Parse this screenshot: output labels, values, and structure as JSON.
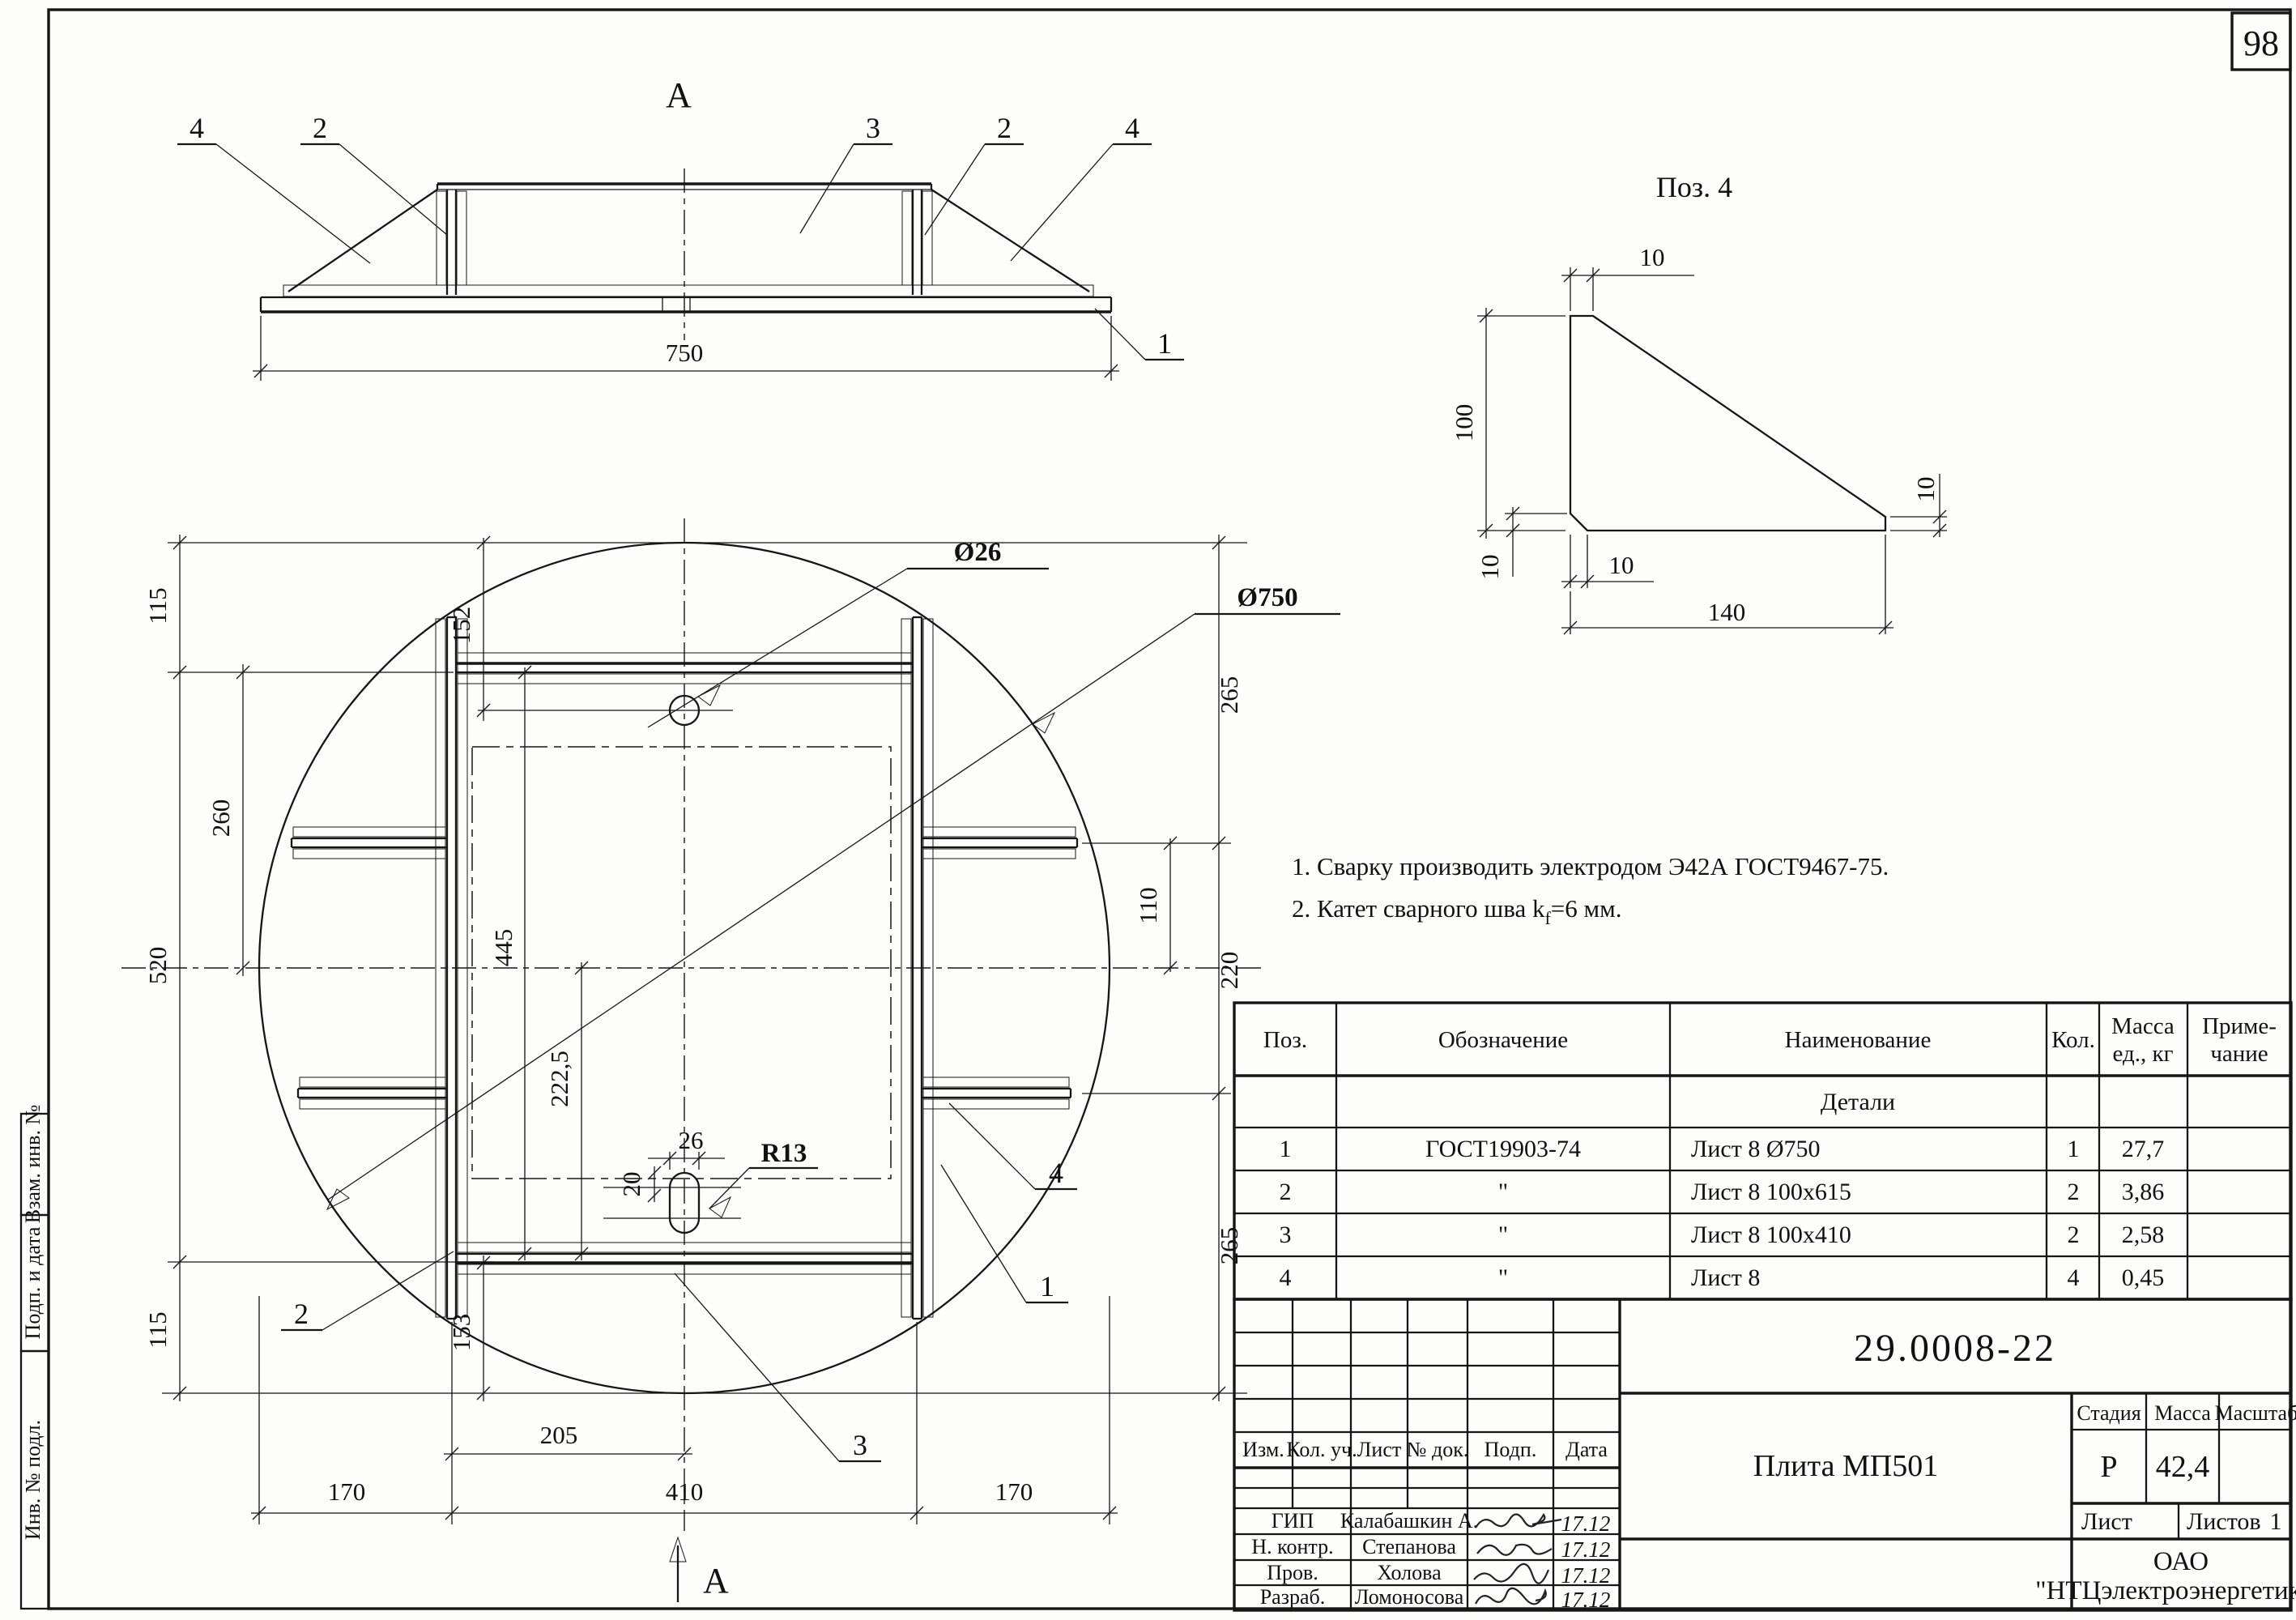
{
  "page": {
    "sheet_number": "98"
  },
  "side_view": {
    "view_label": "А",
    "dim_width": "750",
    "callout_gusset": "4",
    "callout_stiffener": "2",
    "callout_top_plate": "3",
    "callout_base_plate": "1"
  },
  "detail_view": {
    "title": "Поз. 4",
    "dim_10": "10",
    "dim_height": "100",
    "dim_width": "140"
  },
  "plan_view": {
    "section_label": "А",
    "callout_hole_dia": "Ø26",
    "callout_plate_dia": "Ø750",
    "callout_slot_radius": "R13",
    "part_1": "1",
    "part_2": "2",
    "part_3": "3",
    "part_4": "4",
    "dim_152": "152",
    "dim_115": "115",
    "dim_260": "260",
    "dim_520": "520",
    "dim_445": "445",
    "dim_222_5": "222,5",
    "dim_153": "153",
    "dim_265": "265",
    "dim_110": "110",
    "dim_220": "220",
    "dim_205": "205",
    "dim_170": "170",
    "dim_410": "410",
    "dim_slot_26": "26",
    "dim_slot_20": "20"
  },
  "notes": {
    "line1": "1. Сварку производить электродом Э42А ГОСТ9467-75.",
    "line2_prefix": "2. Катет  сварного шва k",
    "line2_sub": "f",
    "line2_suffix": "=6 мм."
  },
  "spec_table": {
    "header_pos": "Поз.",
    "header_designation": "Обозначение",
    "header_name": "Наименование",
    "header_qty": "Кол.",
    "header_mass_1": "Масса",
    "header_mass_2": "ед., кг",
    "header_note_1": "Приме-",
    "header_note_2": "чание",
    "group_row": "Детали",
    "rows": [
      {
        "pos": "1",
        "designation": "ГОСТ19903-74",
        "name": "Лист 8    Ø750",
        "qty": "1",
        "mass": "27,7"
      },
      {
        "pos": "2",
        "designation": "\"",
        "name": "Лист 8    100x615",
        "qty": "2",
        "mass": "3,86"
      },
      {
        "pos": "3",
        "designation": "\"",
        "name": "Лист 8    100x410",
        "qty": "2",
        "mass": "2,58"
      },
      {
        "pos": "4",
        "designation": "\"",
        "name": "Лист 8",
        "qty": "4",
        "mass": "0,45"
      }
    ]
  },
  "title_block": {
    "doc_number": "29.0008-22",
    "title": "Плита МП501",
    "stage_label": "Стадия",
    "mass_label": "Масса",
    "scale_label": "Масштаб",
    "stage_value": "Р",
    "mass_value": "42,4",
    "scale_value": "",
    "sheet_label": "Лист",
    "sheets_label": "Листов",
    "sheets_value": "1",
    "org_line1": "ОАО",
    "org_line2": "\"НТЦэлектроэнергетики\"",
    "rev_headers": [
      "Изм.",
      "Кол. уч.",
      "Лист",
      "№ док.",
      "Подп.",
      "Дата"
    ],
    "signers": [
      {
        "role": "ГИП",
        "name": "Калабашкин А.",
        "date": "17.12"
      },
      {
        "role": "Н. контр.",
        "name": "Степанова",
        "date": "17.12"
      },
      {
        "role": "Пров.",
        "name": "Холова",
        "date": "17.12"
      },
      {
        "role": "Разраб.",
        "name": "Ломоносова",
        "date": "17.12"
      }
    ]
  },
  "margin_stamps": {
    "stamp_bottom": "Инв. № подл.",
    "stamp_middle": "Подп. и дата",
    "stamp_top": "Взам. инв. №"
  }
}
